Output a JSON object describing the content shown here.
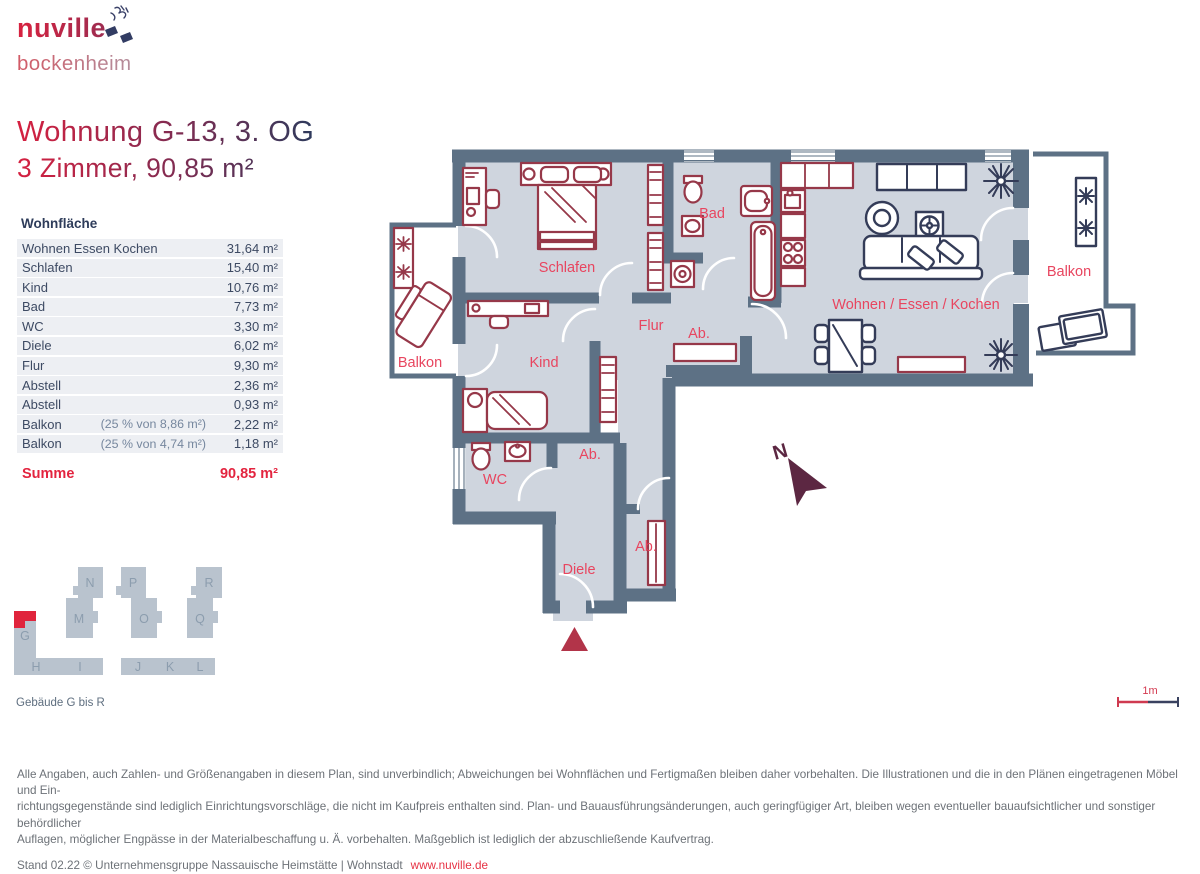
{
  "logo": {
    "brand": "nuville",
    "sub": "bockenheim"
  },
  "title": {
    "line1": "Wohnung G-13, 3. OG",
    "line2": "3 Zimmer, 90,85 m²"
  },
  "area_table": {
    "header": "Wohnfläche",
    "rows": [
      {
        "label": "Wohnen Essen Kochen",
        "note": "",
        "value": "31,64 m²"
      },
      {
        "label": "Schlafen",
        "note": "",
        "value": "15,40 m²"
      },
      {
        "label": "Kind",
        "note": "",
        "value": "10,76 m²"
      },
      {
        "label": "Bad",
        "note": "",
        "value": "7,73 m²"
      },
      {
        "label": "WC",
        "note": "",
        "value": "3,30 m²"
      },
      {
        "label": "Diele",
        "note": "",
        "value": "6,02 m²"
      },
      {
        "label": "Flur",
        "note": "",
        "value": "9,30 m²"
      },
      {
        "label": "Abstell",
        "note": "",
        "value": "2,36 m²"
      },
      {
        "label": "Abstell",
        "note": "",
        "value": "0,93 m²"
      },
      {
        "label": "Balkon",
        "note": "(25 % von 8,86 m²)",
        "value": "2,22 m²"
      },
      {
        "label": "Balkon",
        "note": "(25 % von 4,74 m²)",
        "value": "1,18 m²"
      }
    ],
    "total_label": "Summe",
    "total_value": "90,85 m²"
  },
  "floorplan": {
    "labels": {
      "schlafen": "Schlafen",
      "bad": "Bad",
      "flur": "Flur",
      "ab": "Ab.",
      "kind": "Kind",
      "wc": "WC",
      "diele": "Diele",
      "wohnen": "Wohnen / Essen / Kochen",
      "balkon": "Balkon"
    },
    "compass_label": "N",
    "scale_label": "1m",
    "colors": {
      "wall": "#5d7185",
      "floor": "#cfd5de",
      "furniture_red": "#963849",
      "furniture_ink": "#343c58",
      "room_label": "#e8455f",
      "compass": "#5c2742",
      "entrance_marker": "#b23449"
    }
  },
  "building_key": {
    "blocks": [
      {
        "label": "G"
      },
      {
        "label": "H"
      },
      {
        "label": "I"
      },
      {
        "label": "J"
      },
      {
        "label": "K"
      },
      {
        "label": "L"
      },
      {
        "label": "M"
      },
      {
        "label": "N"
      },
      {
        "label": "O"
      },
      {
        "label": "P"
      },
      {
        "label": "Q"
      },
      {
        "label": "R"
      }
    ],
    "caption": "Gebäude G bis R",
    "highlight_color": "#e0243c"
  },
  "footer": {
    "disclaimer_lines": [
      "Alle Angaben, auch Zahlen- und Größenangaben in diesem Plan, sind unverbindlich; Abweichungen bei Wohnflächen und Fertigmaßen bleiben daher vorbehalten. Die Illustrationen und die in den Plänen eingetragenen Möbel und Ein-",
      "richtungsgegenstände sind lediglich Einrichtungsvorschläge, die nicht im Kaufpreis enthalten sind. Plan- und Bauausführungsänderungen, auch geringfügiger Art, bleiben wegen eventueller bauaufsichtlicher und sonstiger behördlicher",
      "Auflagen, möglicher Engpässe in der Materialbeschaffung u. Ä. vorbehalten. Maßgeblich ist lediglich der abzuschließende Kaufvertrag."
    ],
    "stand": "Stand 02.22 © Unternehmensgruppe Nassauische Heimstätte | Wohnstadt",
    "link": "www.nuville.de"
  }
}
